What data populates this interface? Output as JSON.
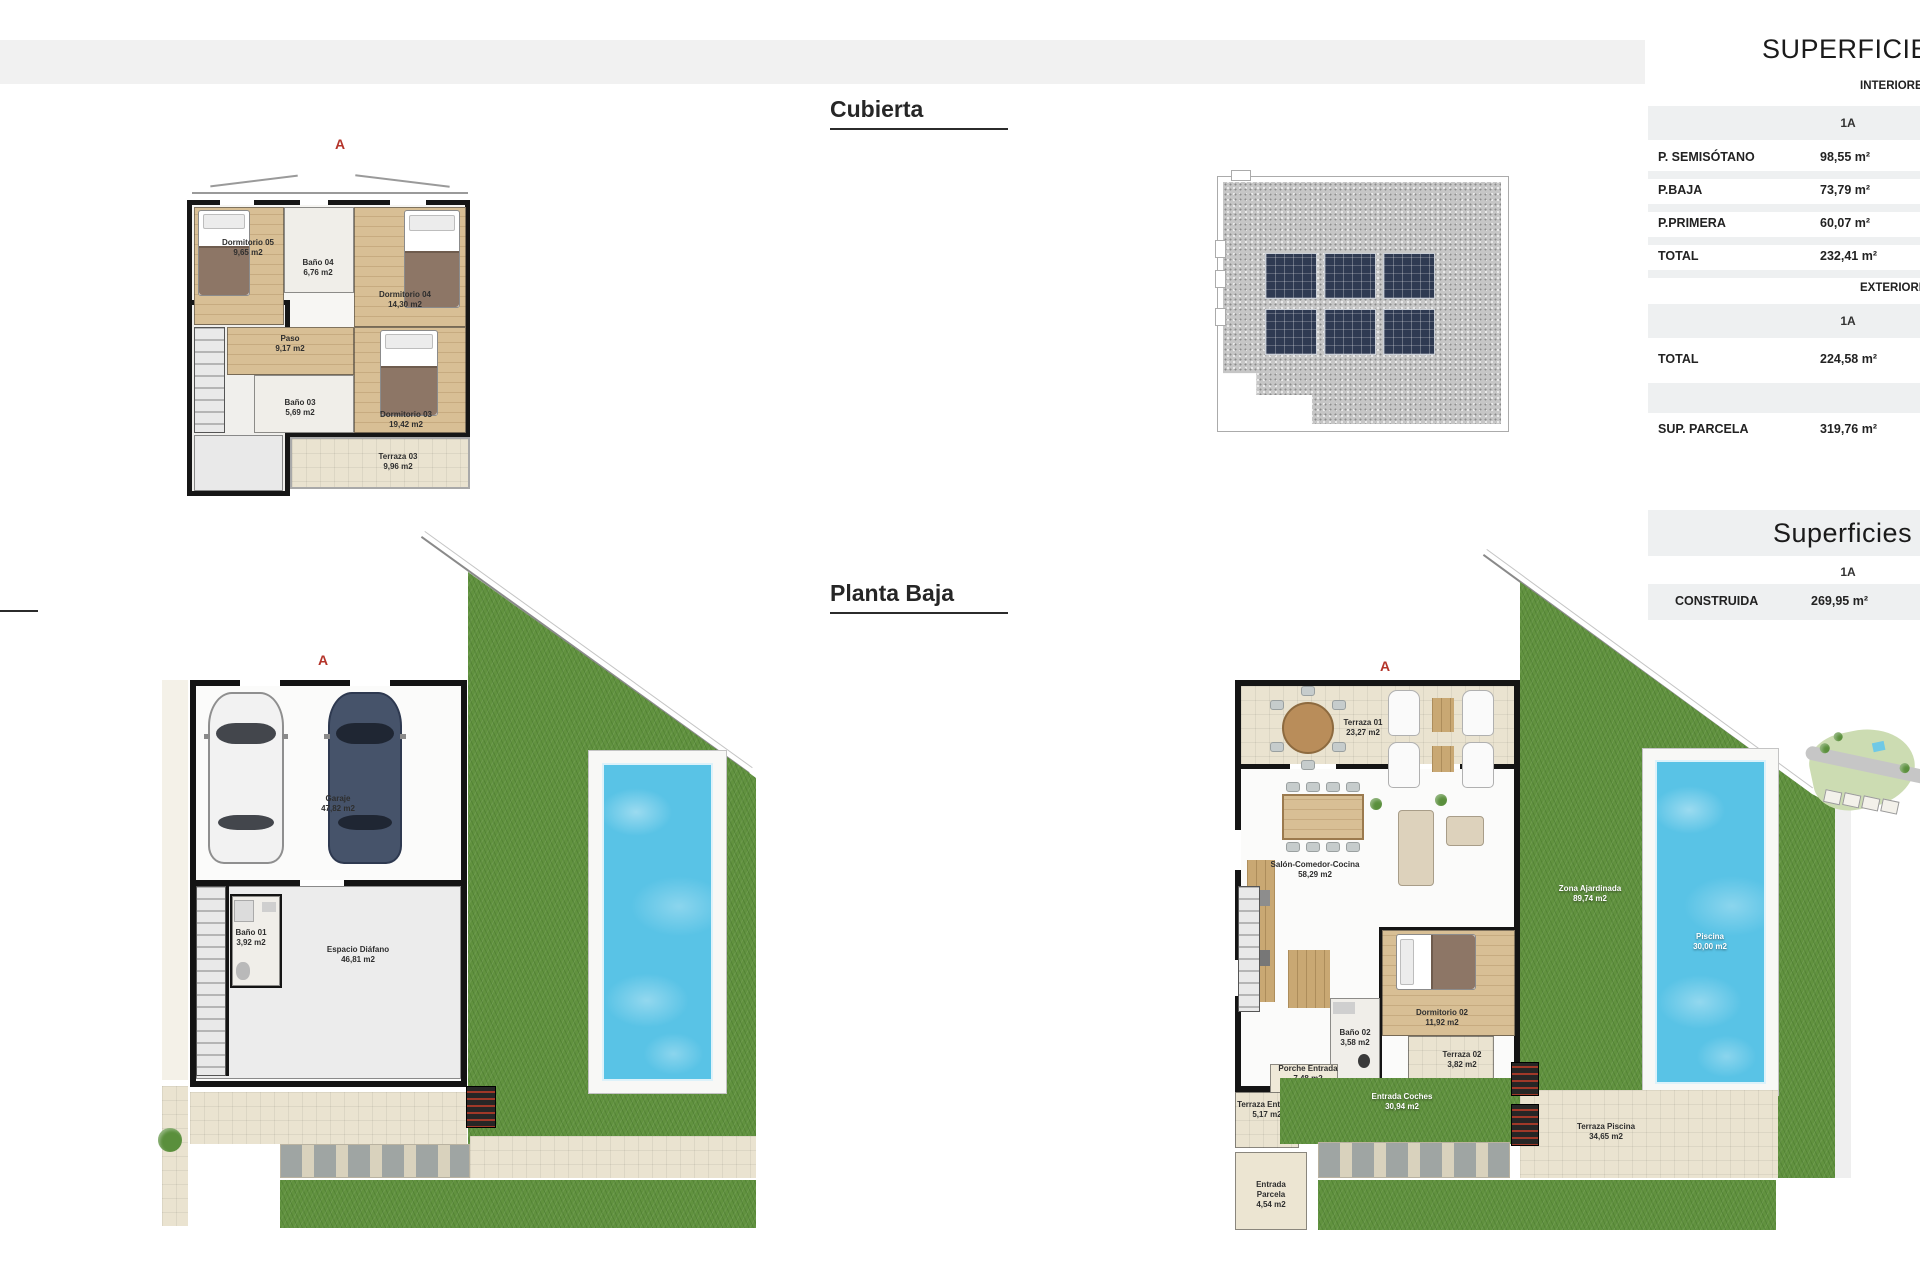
{
  "titles": {
    "cubierta": "Cubierta",
    "planta_baja": "Planta Baja"
  },
  "colors": {
    "accent_red": "#b4342a",
    "grass_green": "#61923f",
    "pool_blue": "#59c3e6",
    "wood": "#d8bf95",
    "terrace_beige": "#eae3d0",
    "wall_black": "#141414",
    "table_stripe": "#eef0f1",
    "solar_panel": "#2f3a52",
    "roof_gravel": "#c6c6c6"
  },
  "tables": {
    "superficie": {
      "title": "SUPERFICIES",
      "interior_header": "INTERIORES",
      "exterior_header": "EXTERIORES",
      "unit": "1A",
      "rows_interior": [
        {
          "label": "P. SEMISÓTANO",
          "value": "98,55 m²"
        },
        {
          "label": "P.BAJA",
          "value": "73,79 m²"
        },
        {
          "label": "P.PRIMERA",
          "value": "60,07 m²"
        },
        {
          "label": "TOTAL",
          "value": "232,41 m²"
        }
      ],
      "rows_exterior": [
        {
          "label": "TOTAL",
          "value": "224,58 m²"
        },
        {
          "label": "SUP. PARCELA",
          "value": "319,76 m²"
        }
      ]
    },
    "construida": {
      "title": "Superficies",
      "unit": "1A",
      "rows": [
        {
          "label": "CONSTRUIDA",
          "value": "269,95 m²"
        }
      ]
    }
  },
  "plans": {
    "primera": {
      "marker": "A",
      "rooms": {
        "dormitorio05": {
          "name": "Dormitorio 05",
          "area": "9,65 m2"
        },
        "bano04": {
          "name": "Baño 04",
          "area": "6,76 m2"
        },
        "dormitorio04": {
          "name": "Dormitorio 04",
          "area": "14,30 m2"
        },
        "paso": {
          "name": "Paso",
          "area": "9,17 m2"
        },
        "bano03": {
          "name": "Baño 03",
          "area": "5,69 m2"
        },
        "dormitorio03": {
          "name": "Dormitorio 03",
          "area": "19,42 m2"
        },
        "terraza03": {
          "name": "Terraza 03",
          "area": "9,96 m2"
        }
      }
    },
    "semisotano": {
      "marker": "A",
      "rooms": {
        "garaje": {
          "name": "Garaje",
          "area": "47,82 m2"
        },
        "bano01": {
          "name": "Baño 01",
          "area": "3,92 m2"
        },
        "espacio": {
          "name": "Espacio Diáfano",
          "area": "46,81 m2"
        }
      }
    },
    "baja": {
      "marker": "A",
      "rooms": {
        "terraza01": {
          "name": "Terraza 01",
          "area": "23,27 m2"
        },
        "salon": {
          "name": "Salón-Comedor-Cocina",
          "area": "58,29 m2"
        },
        "dormitorio02": {
          "name": "Dormitorio 02",
          "area": "11,92 m2"
        },
        "bano02": {
          "name": "Baño 02",
          "area": "3,58 m2"
        },
        "terraza02": {
          "name": "Terraza 02",
          "area": "3,82 m2"
        },
        "porche": {
          "name": "Porche Entrada",
          "area": "7,48 m2"
        },
        "terrazaEntrada": {
          "name": "Terraza Entrada",
          "area": "5,17 m2"
        },
        "entradaParcela": {
          "name": "Entrada Parcela",
          "area": "4,54 m2"
        },
        "entradaCoches": {
          "name": "Entrada Coches",
          "area": "30,94 m2"
        },
        "terrazaPiscina": {
          "name": "Terraza Piscina",
          "area": "34,65 m2"
        },
        "piscina": {
          "name": "Piscina",
          "area": "30,00 m2"
        },
        "zonaAjardinada": {
          "name": "Zona Ajardinada",
          "area": "89,74 m2"
        }
      }
    }
  }
}
